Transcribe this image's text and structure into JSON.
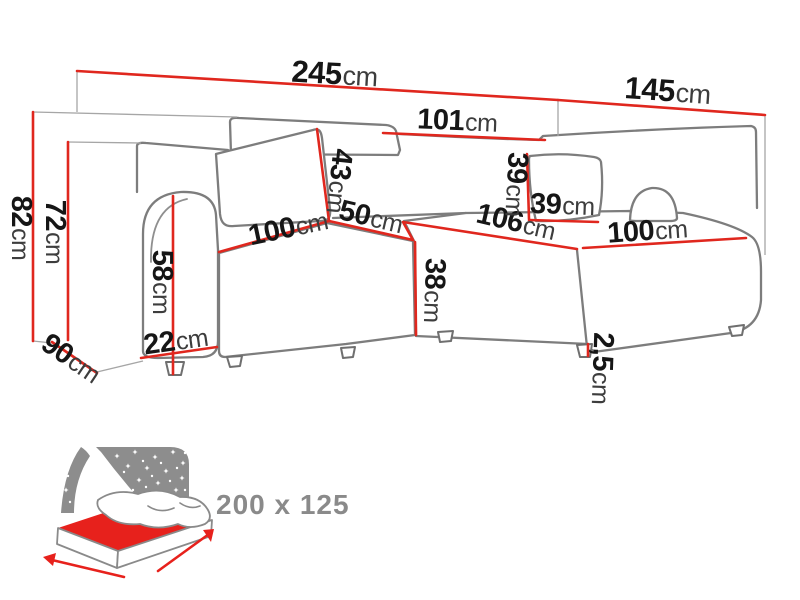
{
  "measurements": {
    "total_width": {
      "value": "245",
      "unit": "cm"
    },
    "total_depth": {
      "value": "145",
      "unit": "cm"
    },
    "back_section_width": {
      "value": "101",
      "unit": "cm"
    },
    "backrest_height": {
      "value": "43",
      "unit": "cm"
    },
    "corner_seat_width": {
      "value": "50",
      "unit": "cm"
    },
    "left_seat_width": {
      "value": "100",
      "unit": "cm"
    },
    "seat_height": {
      "value": "38",
      "unit": "cm"
    },
    "chaise_length": {
      "value": "106",
      "unit": "cm"
    },
    "pillow_height": {
      "value": "39",
      "unit": "cm"
    },
    "pillow_width": {
      "value": "39",
      "unit": "cm"
    },
    "chaise_seat_width": {
      "value": "100",
      "unit": "cm"
    },
    "total_height": {
      "value": "82",
      "unit": "cm"
    },
    "frame_height": {
      "value": "72",
      "unit": "cm"
    },
    "armrest_height": {
      "value": "58",
      "unit": "cm"
    },
    "armrest_width": {
      "value": "22",
      "unit": "cm"
    },
    "side_depth": {
      "value": "90",
      "unit": "cm"
    },
    "leg_height": {
      "value": "2,5",
      "unit": "cm"
    }
  },
  "sleeping_area": {
    "label": "200 x 125"
  },
  "colors": {
    "dimension_line": "#e0271e",
    "sofa_outline": "#7d7d7d",
    "text": "#161616",
    "unit_text": "#3d3d3d",
    "muted_text": "#8a8a8a",
    "mattress_red": "#e7211c",
    "night_sky": "#8d8d8d"
  }
}
